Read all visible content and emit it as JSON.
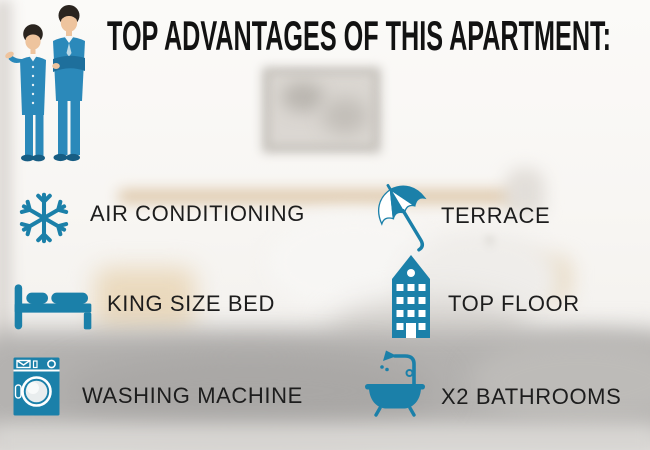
{
  "title": "TOP ADVANTAGES OF THIS APARTMENT:",
  "background_photo": "blurred bedroom with framed picture, headboard, pillows and grey blanket",
  "illustration": "two cartoon businessmen in blue suits",
  "colors": {
    "accent_teal": "#1b80a9",
    "suit_blue": "#2b89ba",
    "title_black": "#121212",
    "label_black": "#1d1d1d"
  },
  "features": {
    "left": [
      {
        "icon": "snowflake-icon",
        "label": "AIR CONDITIONING"
      },
      {
        "icon": "bed-icon",
        "label": "KING SIZE BED"
      },
      {
        "icon": "washing-machine-icon",
        "label": "WASHING MACHINE"
      }
    ],
    "right": [
      {
        "icon": "umbrella-icon",
        "label": "TERRACE"
      },
      {
        "icon": "building-icon",
        "label": "TOP FLOOR"
      },
      {
        "icon": "bathtub-icon",
        "label": "X2 BATHROOMS"
      }
    ]
  }
}
